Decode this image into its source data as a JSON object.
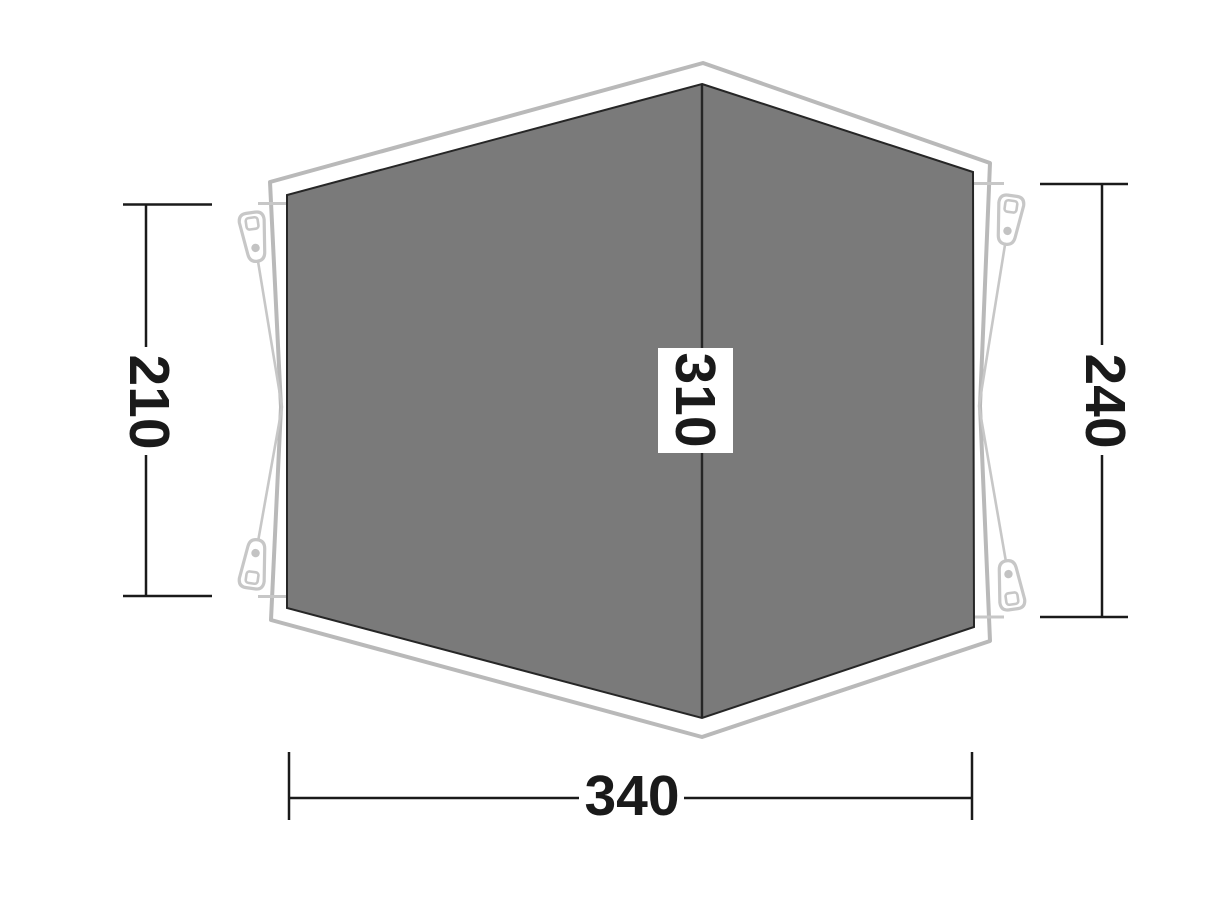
{
  "diagram": {
    "type": "tent-footprint-dimension-diagram",
    "dimensions": {
      "left": {
        "value": "210"
      },
      "right": {
        "value": "240"
      },
      "bottom": {
        "value": "340"
      },
      "ridge": {
        "value": "310"
      }
    },
    "icons": [
      "peg-icon-top-left",
      "peg-icon-top-right",
      "peg-icon-bottom-left",
      "peg-icon-bottom-right"
    ],
    "colors": {
      "background": "#ffffff",
      "floor_fill": "#7a7a7a",
      "floor_stroke": "#262626",
      "ridge_stroke": "#262626",
      "outline_stroke": "#b9b9b9",
      "cord_stroke": "#c7c7c7",
      "peg_stroke": "#c7c7c7",
      "peg_dot_fill": "#c3c3c3",
      "dimension_color": "#1a1a1a",
      "label_box_fill": "#ffffff"
    }
  }
}
